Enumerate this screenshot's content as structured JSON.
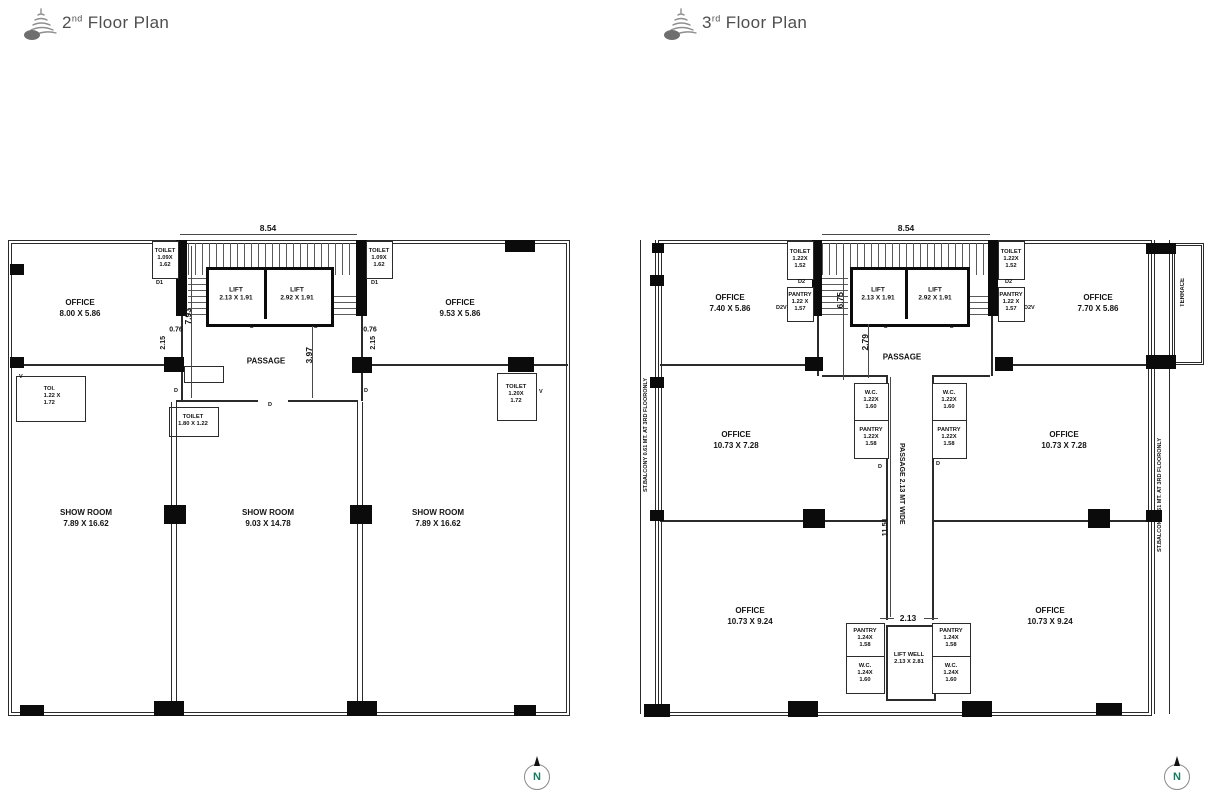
{
  "headers": {
    "plan2": {
      "num": "2",
      "sup": "nd",
      "rest": " Floor Plan"
    },
    "plan3": {
      "num": "3",
      "sup": "rd",
      "rest": " Floor Plan"
    }
  },
  "compass_label": "N",
  "plan2": {
    "office_tl": {
      "n": "OFFICE",
      "d": "8.00 X 5.86"
    },
    "office_tr": {
      "n": "OFFICE",
      "d": "9.53 X 5.86"
    },
    "lift_a": {
      "n": "LIFT",
      "d": "2.13 X 1.91"
    },
    "lift_b": {
      "n": "LIFT",
      "d": "2.92 X 1.91"
    },
    "toilet_core_l": {
      "n": "TOILET",
      "d1": "1.09X",
      "d2": "1.62"
    },
    "toilet_core_r": {
      "n": "TOILET",
      "d1": "1.09X",
      "d2": "1.62"
    },
    "toi_l": {
      "n": "TOI.",
      "d1": "1.22 X",
      "d2": "1.72"
    },
    "toilet_mid": {
      "n": "TOILET",
      "d": "1.80 X 1.22"
    },
    "toilet_r": {
      "n": "TOILET",
      "d1": "1.20X",
      "d2": "1.72"
    },
    "passage": "PASSAGE",
    "showroom_l": {
      "n": "SHOW ROOM",
      "d": "7.89 X 16.62"
    },
    "showroom_m": {
      "n": "SHOW ROOM",
      "d": "9.03 X 14.78"
    },
    "showroom_r": {
      "n": "SHOW ROOM",
      "d": "7.89 X 16.62"
    },
    "dim_854": "8.54",
    "dim_793": "7.93",
    "dim_397": "3.97",
    "dim_076": "0.76",
    "dim_215": "2.15",
    "door_d1": "D1",
    "door_d": "D",
    "door_v": "V"
  },
  "plan3": {
    "office_tl": {
      "n": "OFFICE",
      "d": "7.40 X 5.86"
    },
    "office_tr": {
      "n": "OFFICE",
      "d": "7.70 X 5.86"
    },
    "office_ml": {
      "n": "OFFICE",
      "d": "10.73 X 7.28"
    },
    "office_mr": {
      "n": "OFFICE",
      "d": "10.73 X 7.28"
    },
    "office_bl": {
      "n": "OFFICE",
      "d": "10.73 X 9.24"
    },
    "office_br": {
      "n": "OFFICE",
      "d": "10.73 X 9.24"
    },
    "lift_a": {
      "n": "LIFT",
      "d": "2.13 X 1.91"
    },
    "lift_b": {
      "n": "LIFT",
      "d": "2.92 X 1.91"
    },
    "toilet_core_l": {
      "n": "TOILET",
      "d1": "1.22X",
      "d2": "1.52"
    },
    "toilet_core_r": {
      "n": "TOILET",
      "d1": "1.22X",
      "d2": "1.52"
    },
    "pantry_core_l": {
      "n": "PANTRY",
      "d1": "1.22 X",
      "d2": "1.57"
    },
    "pantry_core_r": {
      "n": "PANTRY",
      "d1": "1.22 X",
      "d2": "1.57"
    },
    "wc_mid_l": {
      "n": "W.C.",
      "d1": "1.22X",
      "d2": "1.60"
    },
    "wc_mid_r": {
      "n": "W.C.",
      "d1": "1.22X",
      "d2": "1.60"
    },
    "pantry_mid_l": {
      "n": "PANTRY",
      "d1": "1.22X",
      "d2": "1.58"
    },
    "pantry_mid_r": {
      "n": "PANTRY",
      "d1": "1.22X",
      "d2": "1.58"
    },
    "pantry_bot_l": {
      "n": "PANTRY",
      "d1": "1.24X",
      "d2": "1.58"
    },
    "pantry_bot_r": {
      "n": "PANTRY",
      "d1": "1.24X",
      "d2": "1.58"
    },
    "wc_bot_l": {
      "n": "W.C.",
      "d1": "1.24X",
      "d2": "1.60"
    },
    "wc_bot_r": {
      "n": "W.C.",
      "d1": "1.24X",
      "d2": "1.60"
    },
    "liftwell": {
      "n": "LIFT WELL",
      "d": "2.13 X 2.81"
    },
    "passage": "PASSAGE",
    "passage_v": "PASSAGE 2.13 MT WIDE",
    "terrace": "TERRACE",
    "balcony": "ST.BALCONY 0.61 MT. AT 3RD FLOORONLY",
    "dim_854": "8.54",
    "dim_675": "6.75",
    "dim_279": "2.79",
    "dim_1151": "11.51",
    "dim_213": "2.13",
    "door_d2": "D2",
    "door_d2v": "D2V",
    "door_d": "D"
  }
}
